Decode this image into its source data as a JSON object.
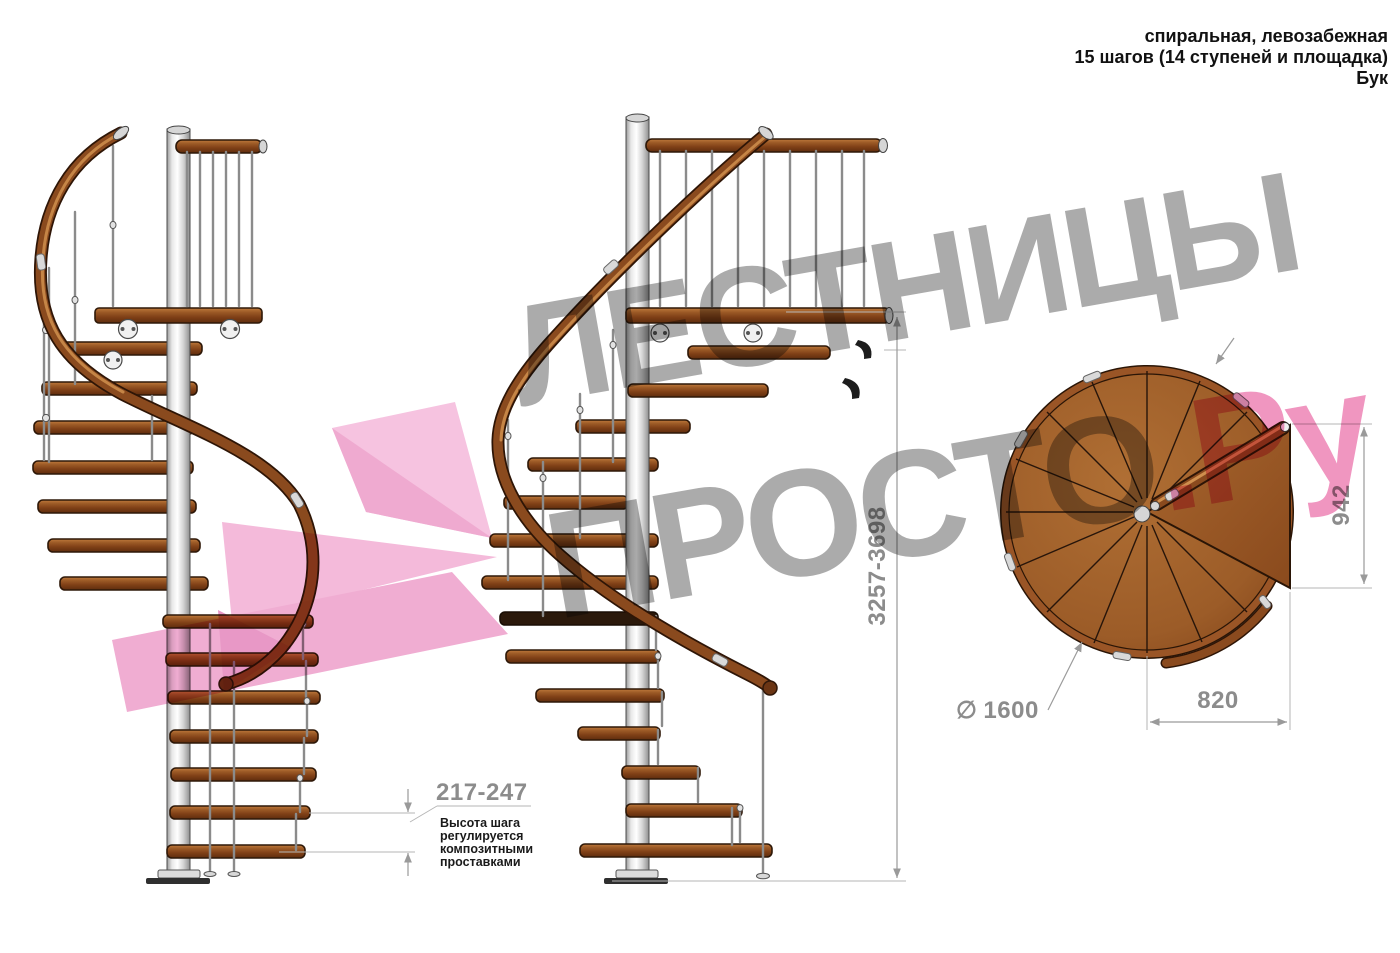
{
  "header": {
    "line1": "спиральная, левозабежная",
    "line2": "15 шагов (14 ступеней и площадка)",
    "line3": "Бук"
  },
  "watermark": {
    "line1": "ЛЕСТНИЦЫ",
    "line2": "ПРОСТО",
    "suffix": ".Ру"
  },
  "dimensions": {
    "total_height": "3257-3698",
    "platform_depth": "942",
    "step_run": "820",
    "diameter_symbol": "∅",
    "diameter_value": "1600",
    "step_height": "217-247"
  },
  "annotation": {
    "lines": [
      "Высота шага",
      "регулируется",
      "композитными",
      "проставками"
    ]
  },
  "colors": {
    "wood": "#8a4a1e",
    "pole": "#d9d9d9",
    "dimension_gray": "#8c8c8c",
    "watermark_gray": "#ababab",
    "watermark_pink": "#f096c0",
    "pink_shape": "#f2b4d7"
  }
}
